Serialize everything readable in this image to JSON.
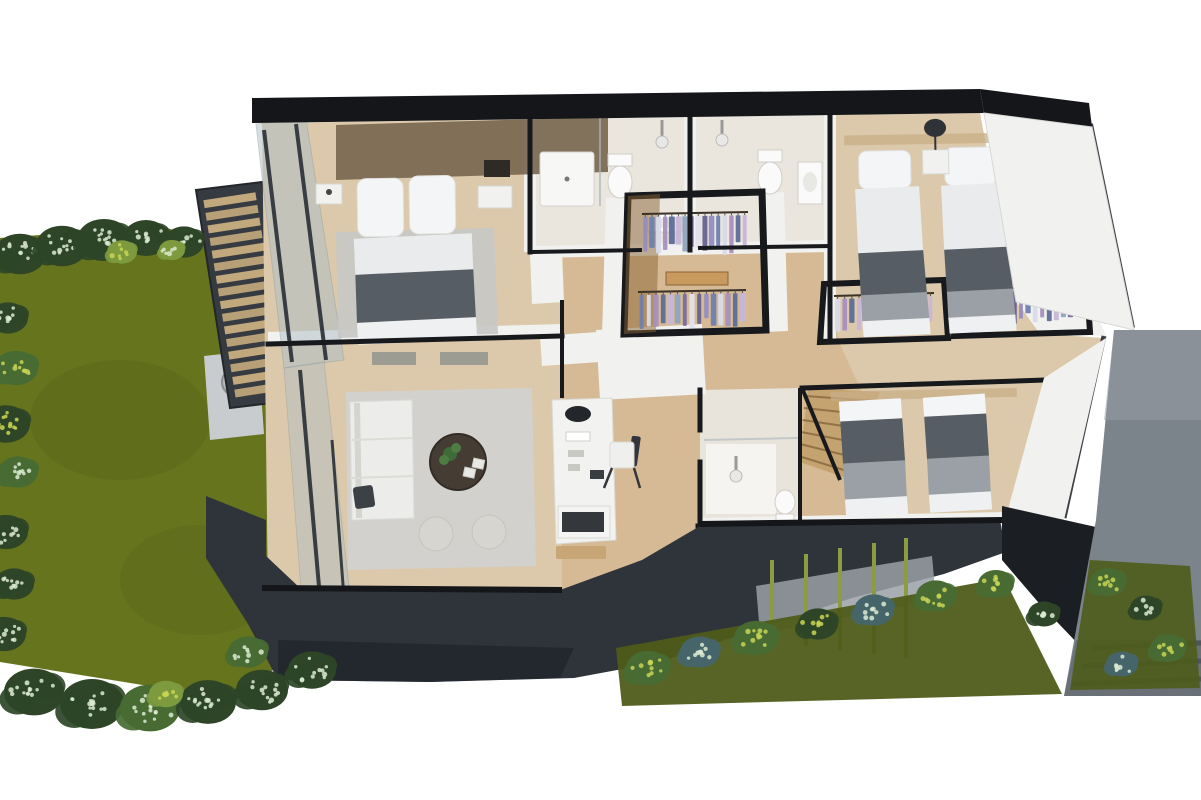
{
  "canvas": {
    "width": 1201,
    "height": 800
  },
  "palette": {
    "bg": "#ffffff",
    "lawn": "#66741d",
    "lawnDark": "#4f5c19",
    "bushDark": "#2e4527",
    "bushMid": "#486b33",
    "bushBlue": "#46656a",
    "bushLight": "#7d9a3f",
    "speckleWhite": "#dcead2",
    "flowerYellow": "#c9d455",
    "stem": "#8d9c43",
    "pergolaFrame": "#363b41",
    "pergolaSlat": "#c2a97d",
    "concrete": "#c8ccce",
    "firepitRing": "#b7bcbf",
    "firepitInner": "#3a3e42",
    "flame": "#d9913f",
    "roof": "#141619",
    "fascia": "#2e343a",
    "fasciaDark": "#1b1f24",
    "wallLine": "#17191d",
    "wallWhite": "#f1f1ef",
    "floorWood": "#dcc9ab",
    "floorWoodWarm": "#cfa97b",
    "tile": "#eae6de",
    "glass": "#aebfc7",
    "mullion": "#2c3238",
    "rug": "#d2d1cd",
    "rugMaster": "#c7c8c5",
    "sofa": "#ececea",
    "cushionDark": "#3c4146",
    "tableDark": "#453c33",
    "plant": "#3f6b3a",
    "pouf": "#d7d5d0",
    "bedSheet": "#e9ebec",
    "bedPillow": "#f4f5f6",
    "bedBlanket": "#575d64",
    "bedBlanketLight": "#9aa0a5",
    "headboard": "#77654e",
    "woodStair": "#c5a370",
    "closetWood": "#b5884e",
    "closetWoodDark": "#8a6336",
    "pathGray": "#7b838b",
    "pathLight": "#99a0a6",
    "pathDark": "#5d646c",
    "deskWhite": "#f2f2f0",
    "deskDecor": "#23262a",
    "chairDark": "#33373c",
    "toiletWhite": "#fafafa",
    "showerHead": "#e8e8e6",
    "lampDark": "#2f3338",
    "clothes": [
      "#938cc0",
      "#7080ad",
      "#d8dae8",
      "#a890bd",
      "#5d6d96",
      "#c7b6d6",
      "#8fa3ba",
      "#7b6a9e",
      "#e3e0ea",
      "#66628e"
    ]
  },
  "decor": {
    "pergola": {
      "tl": [
        203,
        198
      ],
      "tr": [
        255,
        190
      ],
      "br": [
        287,
        392
      ],
      "bl": [
        236,
        400
      ],
      "slats": 16
    },
    "clothes_racks": [
      {
        "x": 642,
        "y": 214,
        "w": 106,
        "h": 36,
        "count": 16,
        "dy": -2
      },
      {
        "x": 638,
        "y": 292,
        "w": 108,
        "h": 32,
        "count": 15,
        "dy": -2
      },
      {
        "x": 834,
        "y": 296,
        "w": 100,
        "h": 30,
        "count": 14,
        "dy": -3
      },
      {
        "x": 968,
        "y": 290,
        "w": 106,
        "h": 30,
        "count": 15,
        "dy": -4
      }
    ],
    "mullions": [
      [
        264,
        130,
        292,
        362,
        4
      ],
      [
        296,
        124,
        326,
        360,
        4
      ],
      [
        300,
        370,
        320,
        598,
        4
      ],
      [
        332,
        440,
        344,
        598,
        3
      ],
      [
        342,
        596,
        344,
        618,
        3
      ],
      [
        392,
        594,
        394,
        616,
        3
      ],
      [
        442,
        592,
        444,
        614,
        3
      ],
      [
        492,
        591,
        494,
        613,
        3
      ],
      [
        542,
        590,
        544,
        612,
        3
      ],
      [
        1090,
        124,
        1132,
        328,
        6
      ],
      [
        1104,
        336,
        1064,
        518,
        5
      ],
      [
        1018,
        170,
        1044,
        300,
        4
      ],
      [
        1048,
        128,
        1062,
        176,
        5
      ],
      [
        1068,
        154,
        1080,
        200,
        5
      ]
    ],
    "stems": [
      [
        772,
        560,
        772,
        642
      ],
      [
        806,
        554,
        806,
        646
      ],
      [
        840,
        548,
        840,
        650
      ],
      [
        874,
        543,
        874,
        654
      ],
      [
        906,
        538,
        906,
        658
      ]
    ],
    "path_steps": [
      [
        1092,
        648,
        1201,
        643
      ],
      [
        1082,
        666,
        1201,
        661
      ],
      [
        1072,
        684,
        1201,
        679
      ]
    ],
    "stairs": {
      "l1": [
        806,
        390
      ],
      "l2": [
        798,
        462
      ],
      "r1": [
        878,
        394
      ],
      "r2": [
        844,
        478
      ],
      "steps": 6
    },
    "bushes": [
      {
        "x": 20,
        "y": 254,
        "r": 26,
        "body": "bushDark",
        "speck": "speckleWhite"
      },
      {
        "x": 62,
        "y": 246,
        "r": 26,
        "body": "bushDark",
        "speck": "speckleWhite"
      },
      {
        "x": 104,
        "y": 240,
        "r": 27,
        "body": "bushDark",
        "speck": "speckleWhite"
      },
      {
        "x": 146,
        "y": 238,
        "r": 23,
        "body": "bushDark",
        "speck": "speckleWhite"
      },
      {
        "x": 184,
        "y": 242,
        "r": 20,
        "body": "bushDark",
        "speck": "speckleWhite"
      },
      {
        "x": 122,
        "y": 252,
        "r": 15,
        "body": "bushLight",
        "speck": "flowerYellow"
      },
      {
        "x": 172,
        "y": 250,
        "r": 13,
        "body": "bushLight",
        "speck": "speckleWhite"
      },
      {
        "x": 8,
        "y": 318,
        "r": 20,
        "body": "bushDark",
        "speck": "speckleWhite"
      },
      {
        "x": 16,
        "y": 368,
        "r": 22,
        "body": "bushMid",
        "speck": "flowerYellow"
      },
      {
        "x": 6,
        "y": 424,
        "r": 24,
        "body": "bushDark",
        "speck": "flowerYellow"
      },
      {
        "x": 18,
        "y": 472,
        "r": 20,
        "body": "bushMid",
        "speck": "speckleWhite"
      },
      {
        "x": 6,
        "y": 532,
        "r": 22,
        "body": "bushDark",
        "speck": "speckleWhite"
      },
      {
        "x": 14,
        "y": 584,
        "r": 20,
        "body": "bushDark",
        "speck": "speckleWhite"
      },
      {
        "x": 4,
        "y": 634,
        "r": 22,
        "body": "bushDark",
        "speck": "speckleWhite"
      },
      {
        "x": 34,
        "y": 692,
        "r": 30,
        "body": "bushDark",
        "speck": "speckleWhite"
      },
      {
        "x": 92,
        "y": 704,
        "r": 32,
        "body": "bushDark",
        "speck": "speckleWhite"
      },
      {
        "x": 150,
        "y": 708,
        "r": 30,
        "body": "bushMid",
        "speck": "speckleWhite"
      },
      {
        "x": 208,
        "y": 702,
        "r": 28,
        "body": "bushDark",
        "speck": "speckleWhite"
      },
      {
        "x": 262,
        "y": 690,
        "r": 26,
        "body": "bushDark",
        "speck": "speckleWhite"
      },
      {
        "x": 312,
        "y": 670,
        "r": 24,
        "body": "bushDark",
        "speck": "speckleWhite"
      },
      {
        "x": 248,
        "y": 652,
        "r": 20,
        "body": "bushMid",
        "speck": "speckleWhite"
      },
      {
        "x": 166,
        "y": 694,
        "r": 17,
        "body": "bushLight",
        "speck": "flowerYellow"
      },
      {
        "x": 648,
        "y": 668,
        "r": 22,
        "body": "bushMid",
        "speck": "flowerYellow"
      },
      {
        "x": 700,
        "y": 652,
        "r": 20,
        "body": "bushBlue",
        "speck": "speckleWhite"
      },
      {
        "x": 756,
        "y": 638,
        "r": 22,
        "body": "bushMid",
        "speck": "flowerYellow"
      },
      {
        "x": 818,
        "y": 624,
        "r": 20,
        "body": "bushDark",
        "speck": "flowerYellow"
      },
      {
        "x": 874,
        "y": 610,
        "r": 20,
        "body": "bushBlue",
        "speck": "speckleWhite"
      },
      {
        "x": 936,
        "y": 596,
        "r": 20,
        "body": "bushMid",
        "speck": "flowerYellow"
      },
      {
        "x": 996,
        "y": 584,
        "r": 18,
        "body": "bushMid",
        "speck": "flowerYellow"
      },
      {
        "x": 1044,
        "y": 614,
        "r": 16,
        "body": "bushDark",
        "speck": "speckleWhite"
      },
      {
        "x": 1108,
        "y": 582,
        "r": 18,
        "body": "bushMid",
        "speck": "flowerYellow"
      },
      {
        "x": 1146,
        "y": 608,
        "r": 16,
        "body": "bushDark",
        "speck": "speckleWhite"
      },
      {
        "x": 1168,
        "y": 648,
        "r": 18,
        "body": "bushMid",
        "speck": "flowerYellow"
      },
      {
        "x": 1122,
        "y": 664,
        "r": 16,
        "body": "bushBlue",
        "speck": "speckleWhite"
      }
    ]
  }
}
